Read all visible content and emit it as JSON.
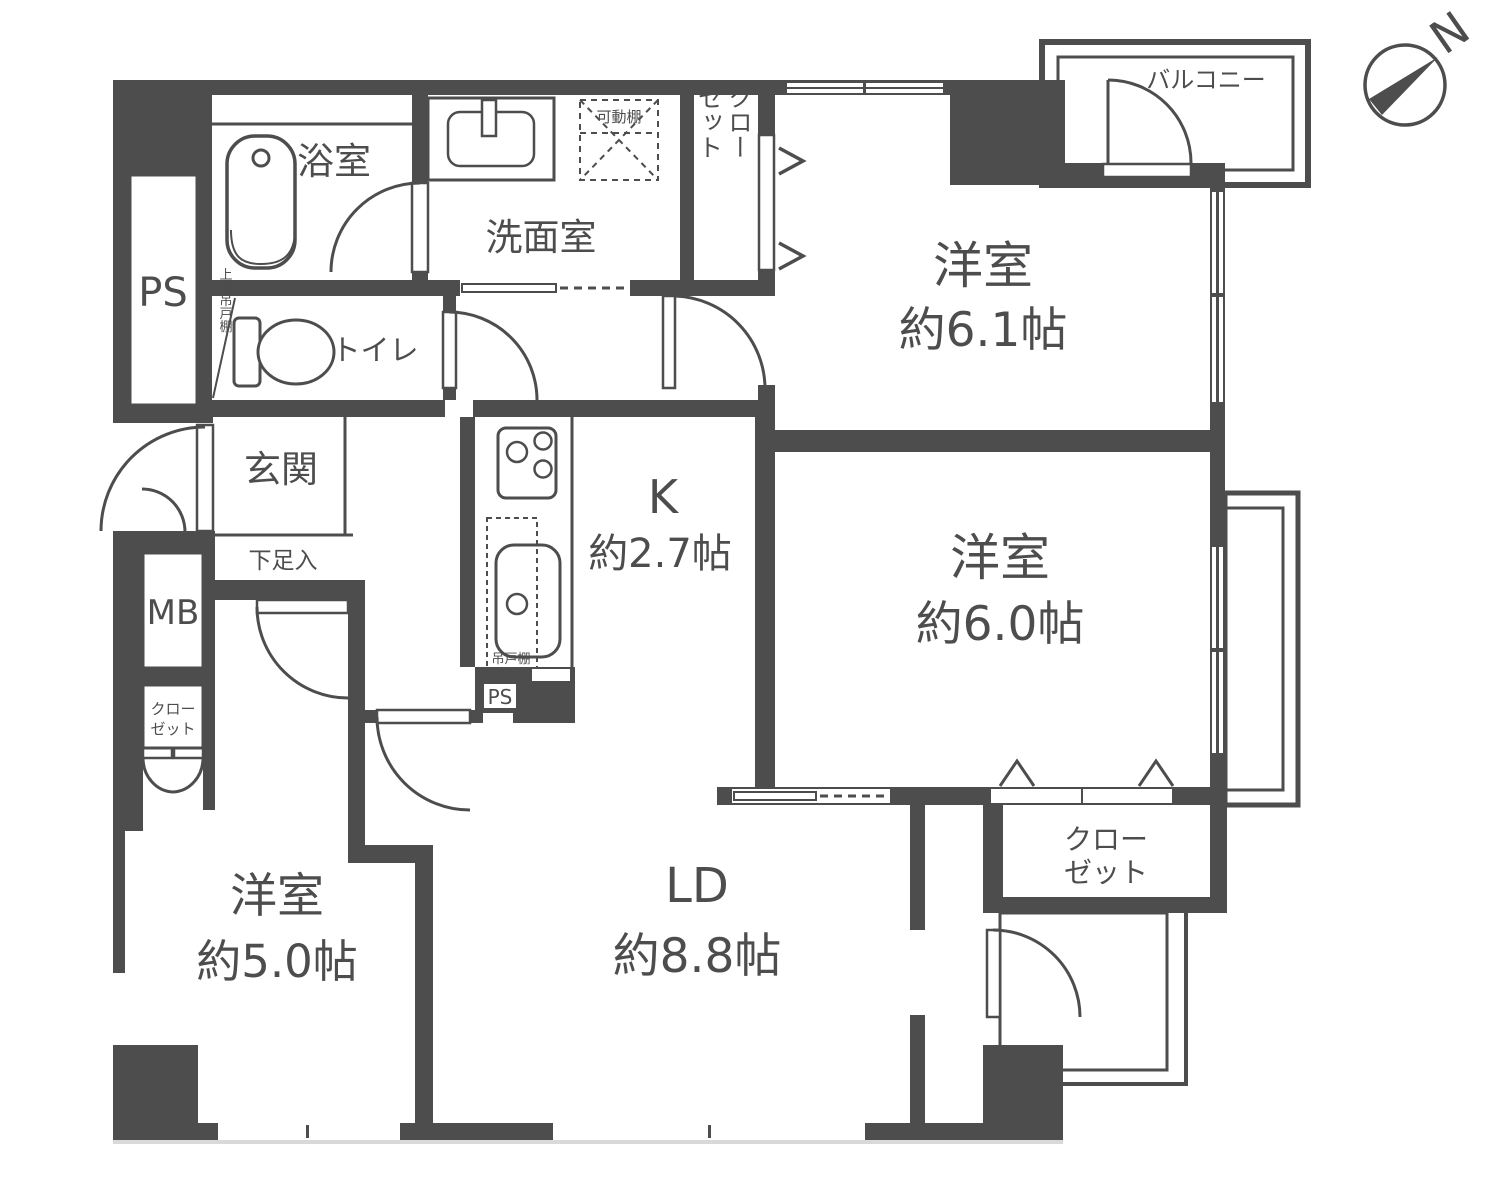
{
  "colors": {
    "wall": "#4d4d4d",
    "bg": "#ffffff",
    "text": "#4d4d4d"
  },
  "compass": {
    "north_label": "N"
  },
  "rooms": {
    "ps_top": {
      "label": "PS"
    },
    "bath": {
      "label": "浴室"
    },
    "washroom": {
      "label": "洗面室"
    },
    "movable_shelf": {
      "label": "可動棚"
    },
    "closet_top": {
      "line1": "クロー",
      "line2": "ゼット"
    },
    "upper_shelf": {
      "label": "上部吊戸棚"
    },
    "toilet": {
      "label": "トイレ"
    },
    "genkan": {
      "label": "玄関"
    },
    "shoe_box": {
      "label": "下足入"
    },
    "mb": {
      "label": "MB"
    },
    "closet_left": {
      "line1": "クロー",
      "line2": "ゼット"
    },
    "kitchen": {
      "name": "K",
      "size": "約2.7帖"
    },
    "hanging_cupboard": {
      "label": "吊戸棚"
    },
    "ps_kitchen": {
      "label": "PS"
    },
    "bedroom_61": {
      "name": "洋室",
      "size": "約6.1帖"
    },
    "balcony": {
      "label": "バルコニー"
    },
    "bedroom_60": {
      "name": "洋室",
      "size": "約6.0帖"
    },
    "closet_br": {
      "line1": "クロー",
      "line2": "ゼット"
    },
    "bedroom_50": {
      "name": "洋室",
      "size": "約5.0帖"
    },
    "living": {
      "name": "LD",
      "size": "約8.8帖"
    }
  }
}
